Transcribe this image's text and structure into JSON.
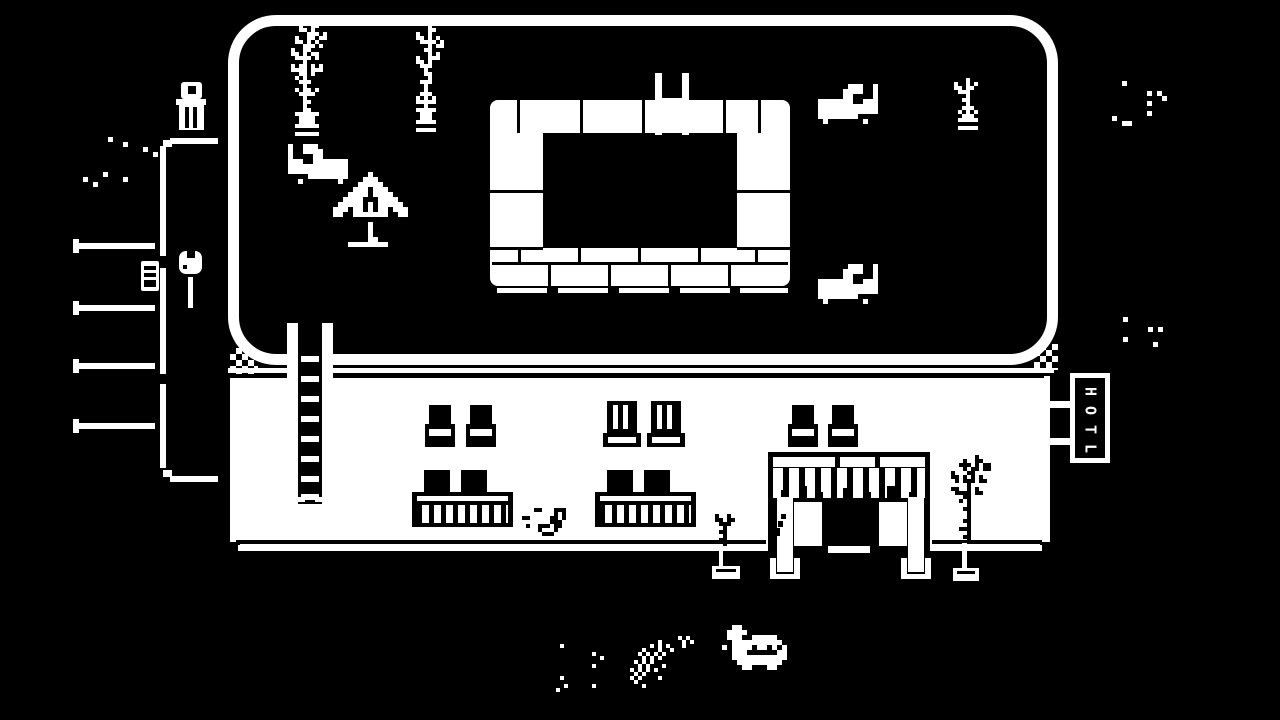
{
  "scene": {
    "title": "1-bit hotel poolside scene",
    "colors": {
      "background": "#000000",
      "foreground": "#ffffff"
    },
    "hotel_sign": {
      "text": "HOTL",
      "letters": [
        "H",
        "O",
        "T",
        "L"
      ]
    },
    "inventory": {
      "lounge_chairs": 3,
      "potted_plants": 5,
      "windows": 6,
      "planter_fences": 2,
      "ladders": 2,
      "creatures": 2
    }
  },
  "sprites": {
    "plantA": {
      "px": 4,
      "fg": "#ffffff",
      "rows": [
        "......x......",
        "...x..xx.....",
        "...xx.x......",
        ".....xxx.x...",
        "..x..xx.xx...",
        "..xx.x.x.....",
        "....xxx.x....",
        ".x..xx.......",
        ".xx.x.xx.....",
        "..xxxx.x.....",
        "....x........",
        ".x.xx.x.x....",
        ".xxxx.xxx....",
        "...xx.x......",
        "..x.x........",
        "...xxx.......",
        "....x........",
        "..x.xx.x.....",
        "...xxxx......",
        "....x........",
        "....xx.......",
        "....x........",
        "....xx.......",
        "..xxxxxx.....",
        "...xxxx......",
        "...xxxx......",
        "..xxxxxx.....",
        ".............",
        "..xxxxxx....."
      ]
    },
    "plantB": {
      "px": 4,
      "fg": "#ffffff",
      "rows": [
        ".....x.......",
        ".....xx......",
        "..x..x.......",
        "..xx.x.x.....",
        "...xxxx.x....",
        ".....x.xx....",
        "....xx.......",
        ".....x.x.....",
        "..x..xxx.....",
        "..xx.x.......",
        "...xxx.......",
        "....x........",
        "....xx.......",
        ".....x.......",
        "...xxx.......",
        "....x........",
        "....x........",
        "...xxx.......",
        "..x.x.x......",
        "..xxxxx......",
        "....x........",
        "..xxxxx......",
        "...xxx.......",
        "...xxx.......",
        "..xxxxx......",
        ".............",
        "..xxxxx......"
      ]
    },
    "smallPlant": {
      "px": 4,
      "fg": "#ffffff",
      "rows": [
        "....x....",
        ".x..x.x..",
        ".xx.xx...",
        "..xxx....",
        "....x....",
        "...xx....",
        "....x....",
        "...xxx...",
        "..x.x.x..",
        "...xxx...",
        "..xxxxx..",
        ".........",
        "..xxxxx.."
      ]
    },
    "lounger": {
      "px": 5,
      "fg": "#ffffff",
      "rows": [
        "......xxx..x.",
        ".....xxxx..x.",
        ".....xx....x.",
        "xxxxxxx..xxx.",
        "xxxxxxxxxxxx.",
        "xxxxxxxxxxxx.",
        "xxxxxxxx.....",
        ".x.......x..."
      ]
    },
    "umbrella": {
      "px": 5,
      "fg": "#ffffff",
      "rows": [
        ".......x........",
        "......xxx.......",
        ".....xxxxx......",
        "....xxx.xxx.....",
        "...xxxx.xxxx....",
        "..xxxx...xxxx...",
        ".xxxxx.x.xxxxx..",
        "xxx.xx.x.xx.xxx.",
        "xx..xxxxxxx..xx.",
        "................",
        ".......x........",
        ".......x........",
        ".......x........",
        ".......xx.......",
        "...xxxxxxxx....."
      ]
    },
    "plantEntranceRight": {
      "px": 4,
      "fg": "#000000",
      "rows": [
        "........x......",
        ".....x..xx.....",
        "....xxx.x.xx...",
        ".....x.xx.xx...",
        "..x...xx.......",
        "..xx.x.x.x.....",
        "...x.xxx.xx....",
        "......x........",
        "..xx..x.x......",
        "...xxxx.xx.....",
        ".....xx........",
        "....x.x........",
        "......x........",
        ".....xx........",
        "......x........",
        "......x........",
        ".....xx........",
        "......x........",
        "....xxx........",
        "......x........",
        ".....xx........",
        "......x........"
      ]
    },
    "plantEntranceLeft": {
      "px": 4,
      "fg": "#000000",
      "rows": [
        ".x..x...",
        ".xx.xx..",
        "..xxx...",
        "...x....",
        "..xx....",
        "...x....",
        "..xx....",
        "...x...."
      ]
    },
    "crab": {
      "px": 4,
      "fg": "#000000",
      "rows": [
        "....xx...xxx.",
        ".........x.x.",
        ".xx.....xx.x.",
        "........xxx..",
        "..x..xxx.xx..",
        ".....x...x...",
        "......xxx...."
      ]
    },
    "turtle": {
      "px": 5,
      "fg": "#ffffff",
      "rows": [
        "....xx..........",
        "...xxxx.........",
        "...xxx..xxxxx...",
        "....xxxxxxxxxx..",
        "..x.xxxx.xx.x.x.",
        "....xxx......xx.",
        "....xxxxxxxxxxx.",
        ".....xxxxxxxxx..",
        "......xx...xx..."
      ]
    },
    "specksTL": {
      "px": 5,
      "fg": "#ffffff",
      "rows": [
        "..................",
        "..................",
        "..................",
        "..................",
        "..................",
        "......x...........",
        ".........x........",
        ".............x....",
        "...............x..",
        "..................",
        "..................",
        "..................",
        ".....x............",
        ".x.......x........",
        "...x.............."
      ]
    },
    "specksTR1": {
      "px": 5,
      "fg": "#ffffff",
      "rows": [
        "...........",
        "..x........",
        "...........",
        ".......x.x.",
        "..........x",
        ".......x...",
        "...........",
        ".......x...",
        "x..........",
        "..xx......."
      ]
    },
    "specksTR2": {
      "px": 5,
      "fg": "#ffffff",
      "rows": [
        "..........",
        ".x........",
        "..........",
        "......x.x.",
        "..........",
        ".x........",
        ".......x..",
        ".........."
      ]
    },
    "trailA": {
      "px": 4,
      "fg": "#ffffff",
      "rows": [
        ".............",
        "..x..........",
        ".............",
        "..........x..",
        "............x",
        ".............",
        "..........x..",
        ".............",
        ".............",
        "..x..........",
        ".............",
        "...x......x..",
        ".x..........."
      ]
    },
    "trailB": {
      "px": 4,
      "fg": "#ffffff",
      "rows": [
        ".............x.x.....",
        "........x.....x.x...",
        "......x.x.x...x......",
        "....x...x..x.........",
        "...x.x.x.x...........",
        "....x.x.x............",
        "..x.x.x..............",
        "...x.x...x...........",
        ".x.x.x.x.............",
        "..x.x................",
        ".x.x....x............",
        "..x..................",
        "....x................"
      ]
    }
  }
}
